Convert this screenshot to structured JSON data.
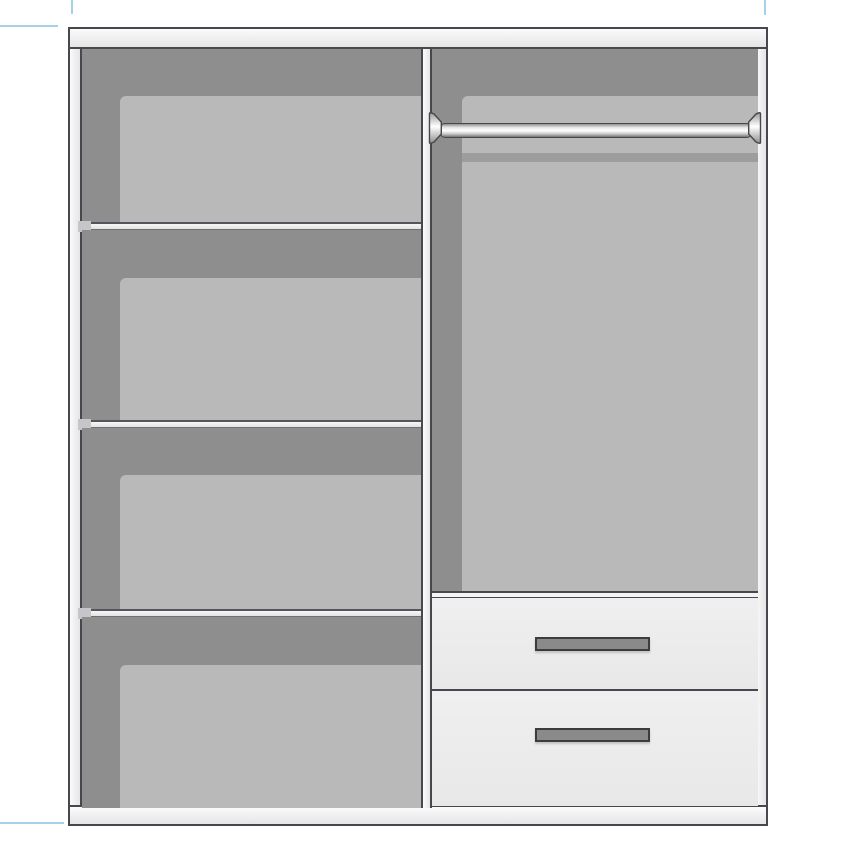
{
  "title": "Wardrobe interior cutaway illustration",
  "diagram": {
    "type": "wardrobe-interior-diagram",
    "left_section": {
      "compartments": 4,
      "shelves": 3
    },
    "right_section": {
      "hanging_rails": 1,
      "drawers": 2,
      "drawer_handles": 2
    },
    "annotations": "none (no text rendered in image)"
  },
  "colors": {
    "page-bg": "#ffffff",
    "frame": "#f2f1f1",
    "frame-light": "#fafafa",
    "frame-dark": "#e6e5e5",
    "line": "#47474d",
    "line-soft": "#6f6f6f",
    "back-panel": "#8e8e8e",
    "inset-panel": "#b9b9b9",
    "rail-shadow": "#9d9d9d",
    "drawer-front": "#edecec",
    "handle-fill": "#8a8a8a",
    "handle-border": "#3c3c3c",
    "guide": "#a5d2e6",
    "shelf-end": "#c6c6ca"
  }
}
